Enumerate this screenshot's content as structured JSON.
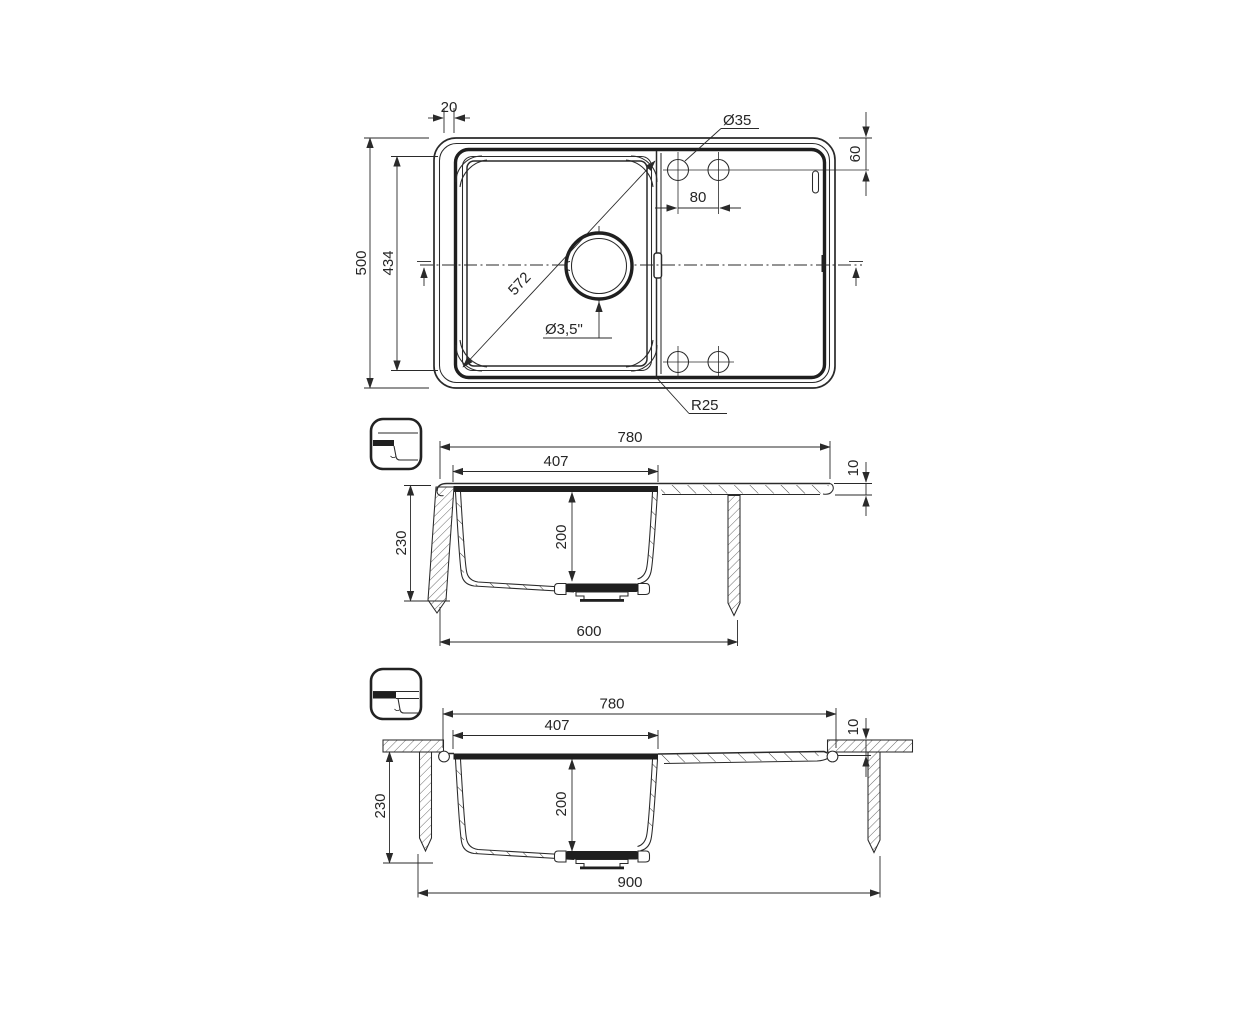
{
  "drawing": {
    "background_color": "#ffffff",
    "line_color": "#2a2a2a",
    "type_label": "kitchen sink technical drawing"
  },
  "top_view": {
    "dims": {
      "rim_width": "20",
      "overall_depth": "500",
      "bowl_depth": "434",
      "faucet_hole_diameter": "Ø35",
      "hole_edge_offset": "60",
      "hole_spacing": "80",
      "bowl_diagonal": "572",
      "drain_size": "Ø3,5\"",
      "corner_radius": "R25"
    }
  },
  "section_inset": {
    "dims": {
      "overall_width": "780",
      "bowl_width": "407",
      "rim_thickness": "10",
      "total_depth": "230",
      "bowl_depth": "200",
      "cabinet_width": "600"
    }
  },
  "section_flush": {
    "dims": {
      "overall_width": "780",
      "bowl_width": "407",
      "rim_thickness": "10",
      "total_depth": "230",
      "bowl_depth": "200",
      "cabinet_width": "900"
    }
  }
}
